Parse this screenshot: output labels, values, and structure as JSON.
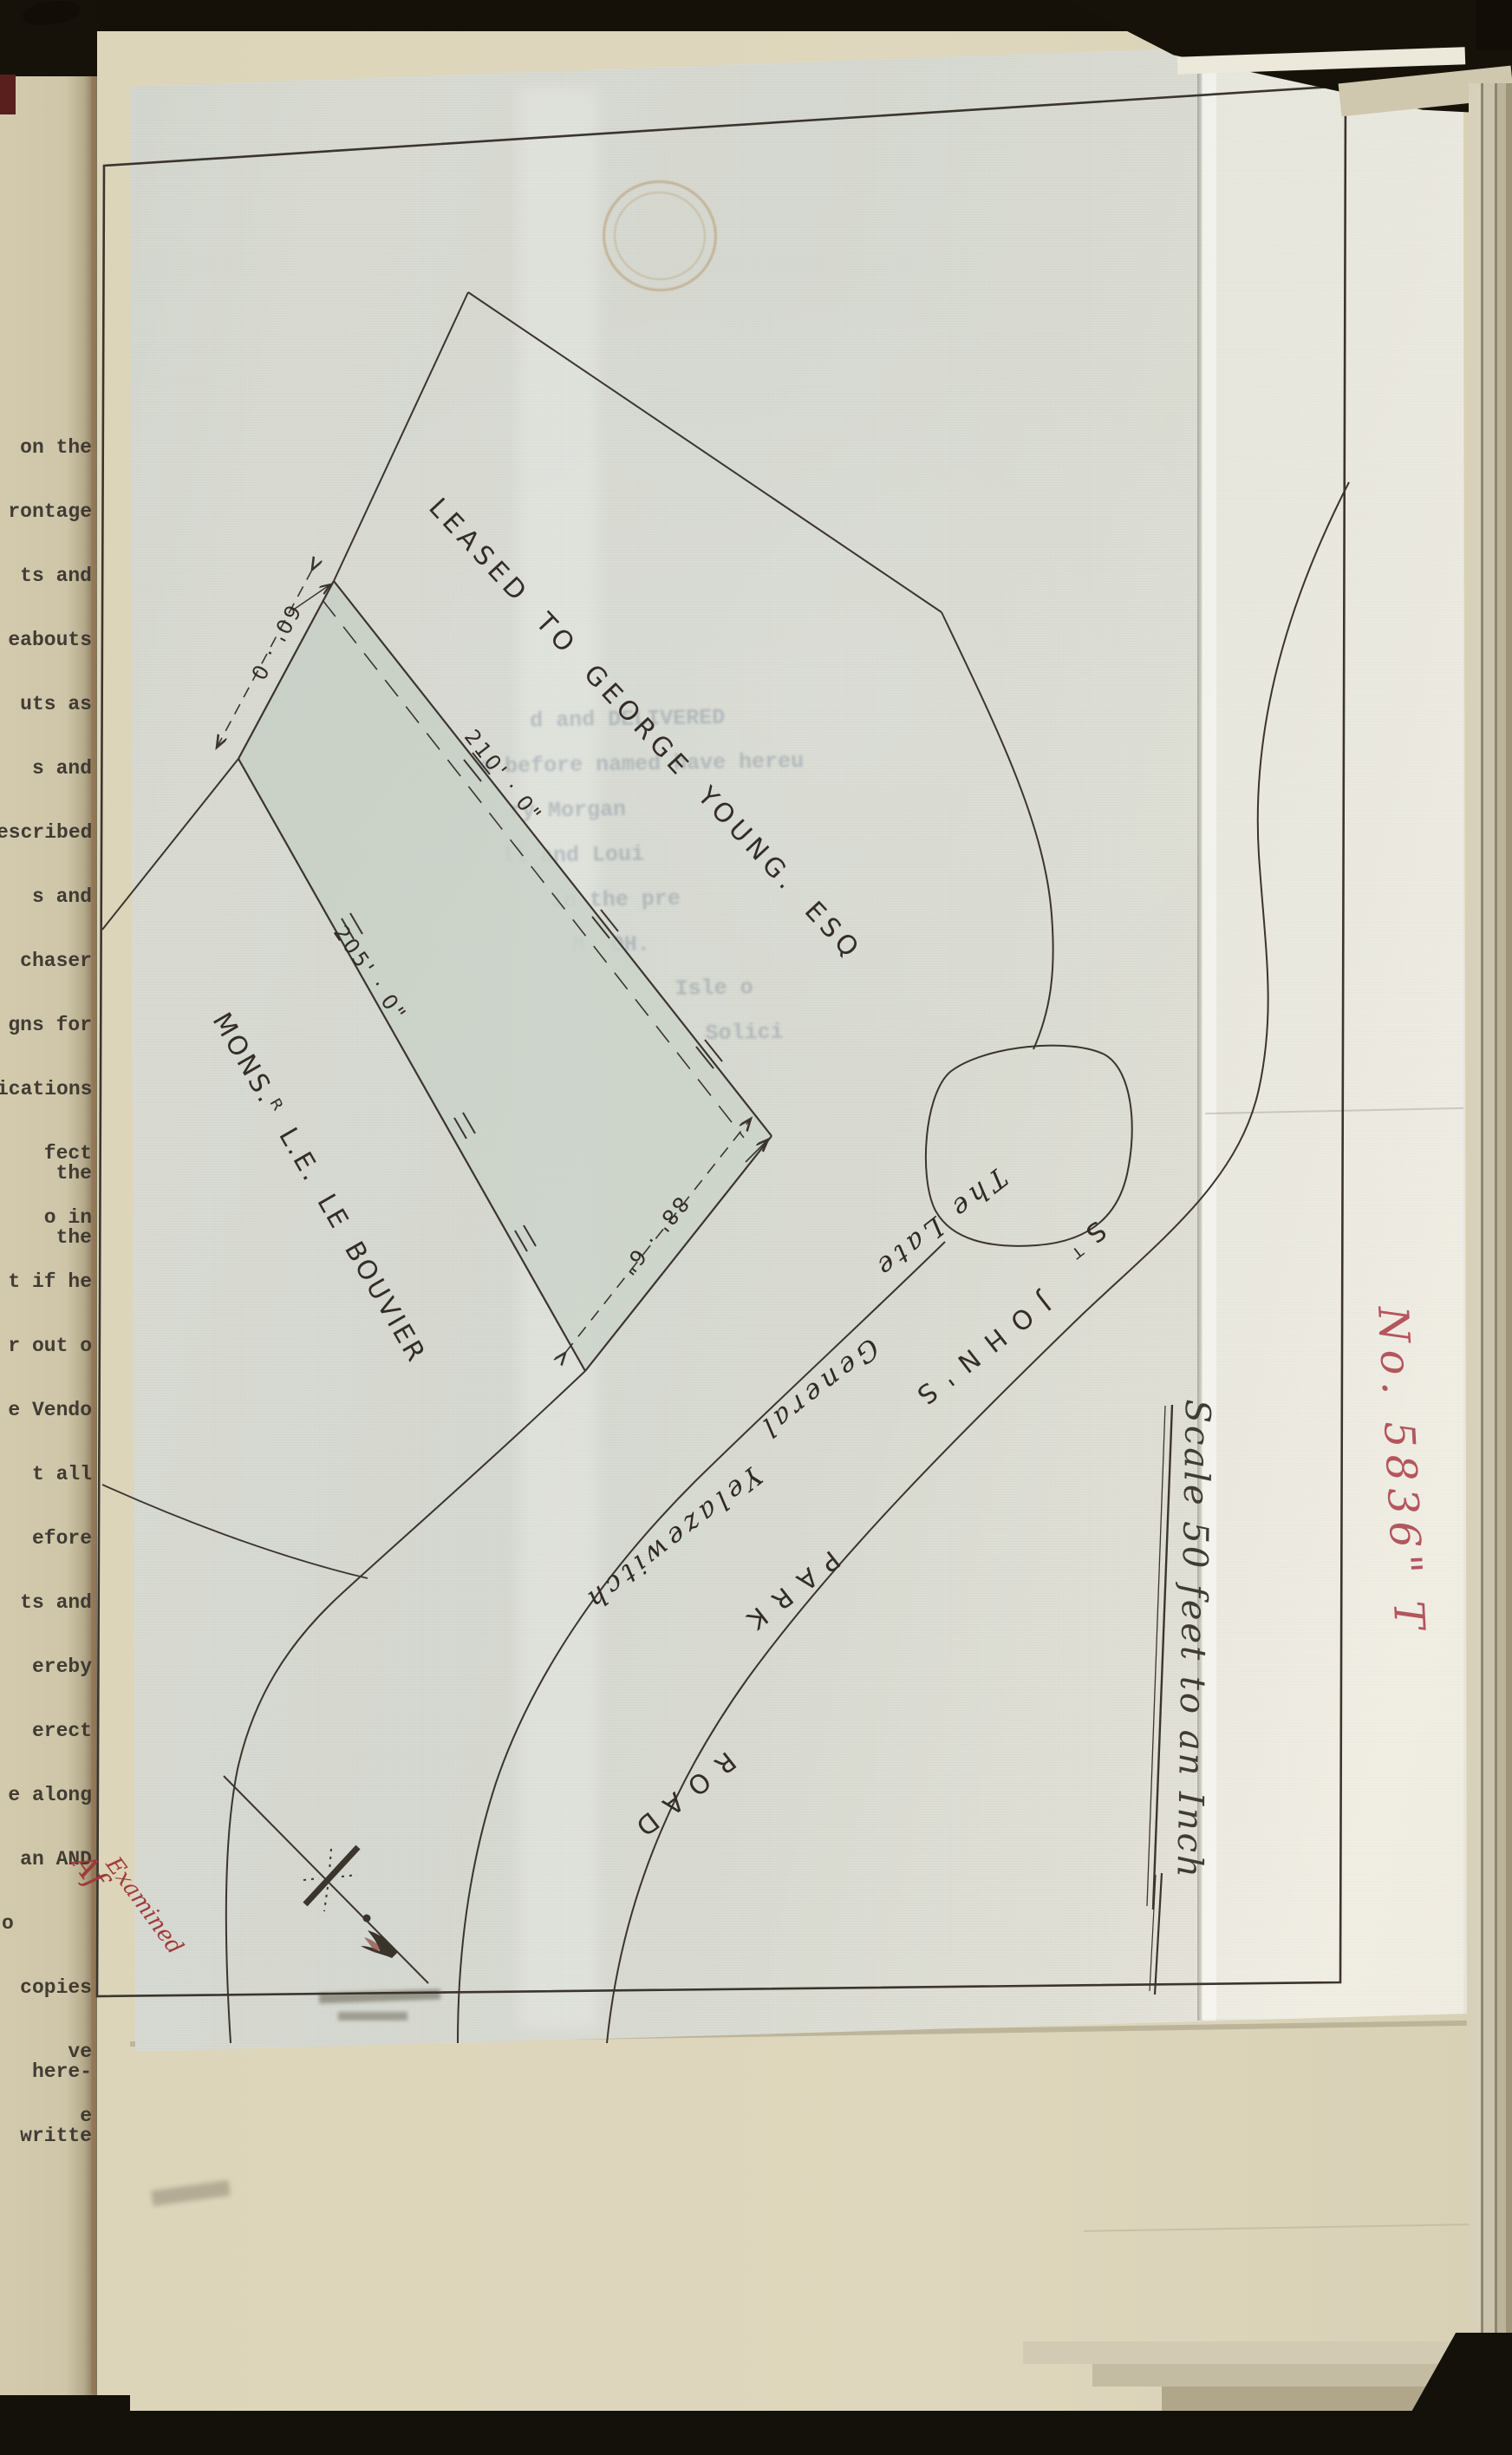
{
  "colors": {
    "red_ink": "#a83f3a",
    "red_number_ink": "#b4555c",
    "parcel_fill": "#c9d1c7",
    "line_ink": "#3b352d",
    "paper_sheet": "#d9dbd2",
    "paper_page": "#ddd5ba"
  },
  "book": {
    "left_page_fragments": [
      "on the",
      "rontage",
      "ts and",
      "eabouts",
      "uts as",
      "s and",
      "escribed",
      "s and",
      "chaser",
      "gns for",
      "ications",
      "fect the",
      "o in the",
      "t if he",
      "r out o",
      "e Vendo",
      "t all",
      "efore",
      "ts and",
      "ereby",
      "erect",
      "e along",
      "an AND",
      "o",
      "copies",
      "ve here-",
      "e writte"
    ],
    "red_number": "No. 5836\" T",
    "examined_note": "Examined",
    "examined_initials": "Af"
  },
  "plan": {
    "leased_label": "LEASED TO GEORGE YOUNG. ESQ",
    "owner_label": "MONS.ᴿ L.E. LE BOUVIER",
    "strip_words": [
      "The Late",
      "General",
      "Yelazewitch"
    ],
    "road_words": [
      "Sᵀ",
      "JOHN'S",
      "PARK",
      "ROAD"
    ],
    "dimensions": {
      "top_edge": "60' · 0",
      "northeast_edge": "210' · 0\"",
      "southwest_edge": "205' · 0\"",
      "southeast_edge": "88' · 6\""
    },
    "scale_note": "Scale 50 feet to an Inch",
    "bleedthrough_lines": [
      "d and DELIVERED",
      "e before named have hereu",
      "ry Morgan",
      "ll and Loui",
      "in the pre",
      "M.  OH.",
      "Isle o",
      "Solici"
    ]
  }
}
